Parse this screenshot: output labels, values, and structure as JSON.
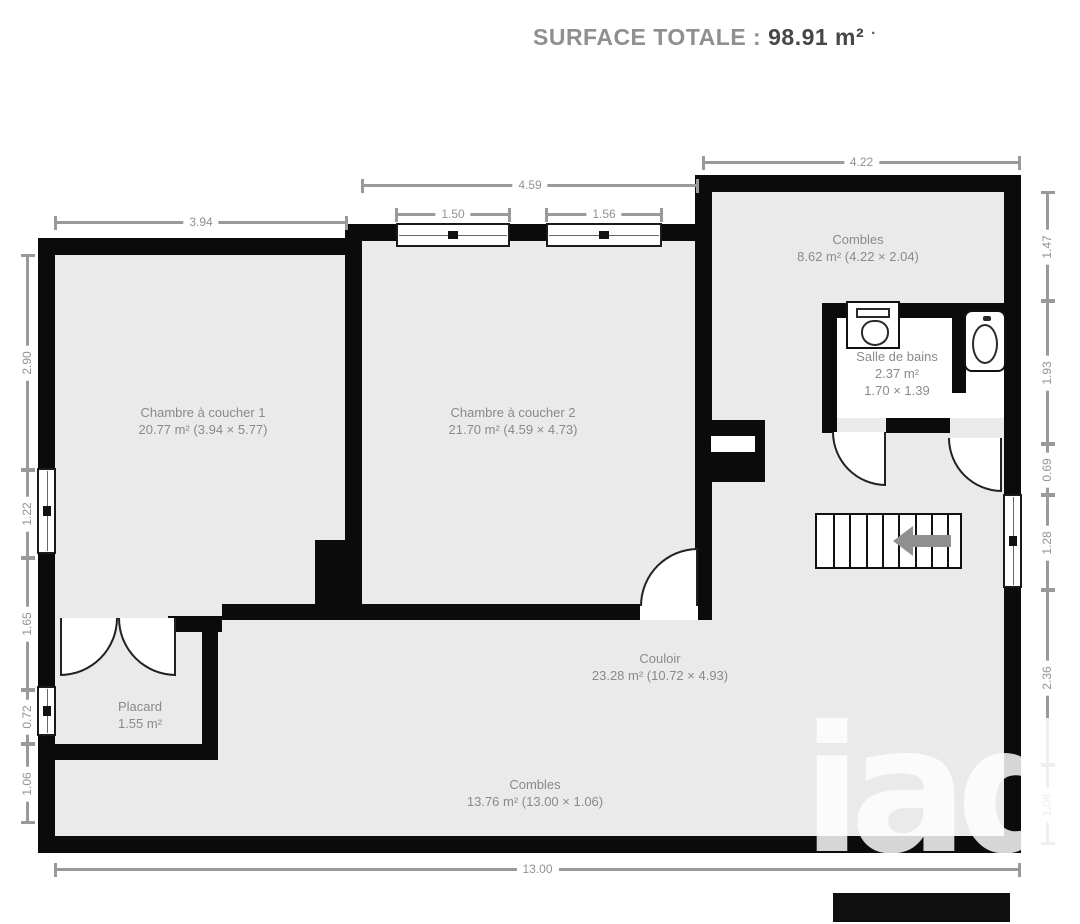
{
  "title": {
    "label": "SURFACE TOTALE :",
    "value": "98.91 m²",
    "dot": "·"
  },
  "rooms": {
    "chambre1": {
      "name": "Chambre à coucher 1",
      "details": "20.77 m² (3.94 × 5.77)"
    },
    "chambre2": {
      "name": "Chambre à coucher 2",
      "details": "21.70 m² (4.59 × 4.73)"
    },
    "combles_haut": {
      "name": "Combles",
      "details": "8.62 m² (4.22 × 2.04)"
    },
    "salle_de_bains": {
      "name": "Salle de bains",
      "area": "2.37 m²",
      "dims": "1.70 × 1.39"
    },
    "couloir": {
      "name": "Couloir",
      "details": "23.28 m² (10.72 × 4.93)"
    },
    "combles_bas": {
      "name": "Combles",
      "details": "13.76 m² (13.00 × 1.06)"
    },
    "placard": {
      "name": "Placard",
      "area": "1.55 m²"
    }
  },
  "dimensions": {
    "top": [
      "3.94",
      "4.59",
      "1.50",
      "1.56",
      "4.22"
    ],
    "left": [
      "2.90",
      "1.22",
      "1.65",
      "0.72",
      "1.06"
    ],
    "right": [
      "1.47",
      "1.93",
      "0.69",
      "1.28",
      "2.36",
      "1.06"
    ],
    "bottom": [
      "13.00"
    ]
  },
  "watermark": {
    "text": "iad"
  },
  "colors": {
    "wall": "#0b0b0b",
    "room_fill": "#eaeaea",
    "dimension_gray": "#949494",
    "label_gray": "#8a8a8a",
    "watermark_gray": "#d4d4d4"
  }
}
